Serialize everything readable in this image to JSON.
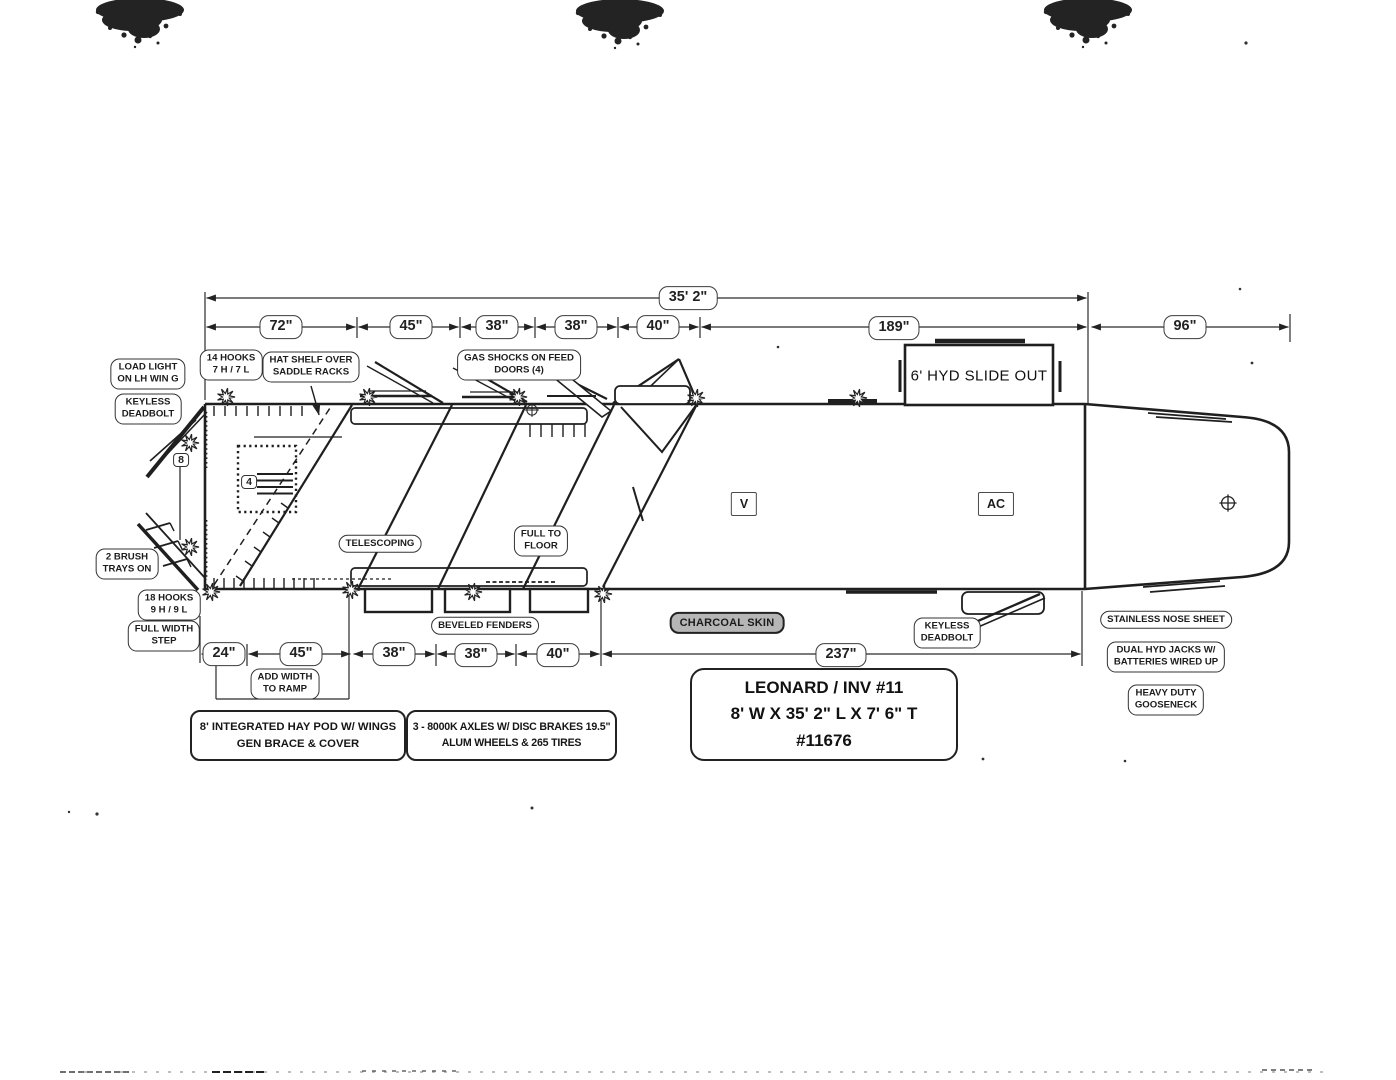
{
  "dims": {
    "overall": "35' 2\"",
    "top": [
      "72\"",
      "45\"",
      "38\"",
      "38\"",
      "40\"",
      "189\"",
      "96\""
    ],
    "bottom": [
      "24\"",
      "45\"",
      "38\"",
      "38\"",
      "40\"",
      "237\""
    ]
  },
  "notes": {
    "load_light": "LOAD LIGHT\nON LH WIN G",
    "keyless_rear": "KEYLESS\nDEADBOLT",
    "hooks_14": "14 HOOKS\n7 H / 7 L",
    "hat_shelf": "HAT SHELF OVER\nSADDLE RACKS",
    "gas_shocks": "GAS SHOCKS ON FEED\nDOORS (4)",
    "brush_trays": "2 BRUSH\nTRAYS ON",
    "hooks_18": "18 HOOKS\n9 H / 9 L",
    "full_width_step": "FULL WIDTH\nSTEP",
    "telescoping": "TELESCOPING",
    "full_to_floor": "FULL TO\nFLOOR",
    "add_width": "ADD WIDTH\nTO RAMP",
    "beveled_fenders": "BEVELED FENDERS",
    "charcoal_skin": "CHARCOAL SKIN",
    "keyless_front": "KEYLESS\nDEADBOLT",
    "stainless_nose": "STAINLESS NOSE SHEET",
    "dual_hyd": "DUAL HYD JACKS W/\nBATTERIES WIRED UP",
    "heavy_duty": "HEAVY DUTY\nGOOSENECK",
    "slide_out": "6' HYD SLIDE OUT",
    "vent": "V",
    "ac": "AC",
    "num_8": "8",
    "num_4": "4"
  },
  "title_block": {
    "line1": "LEONARD / INV #11",
    "line2": "8' W X 35' 2\" L X 7' 6\" T",
    "line3": "#11676"
  },
  "callouts": {
    "hay_pod": "8' INTEGRATED HAY POD W/ WINGS\nGEN BRACE & COVER",
    "axles": "3 - 8000K AXLES W/ DISC BRAKES 19.5\"\nALUM WHEELS & 265 TIRES"
  },
  "colors": {
    "ink": "#1f1f1f",
    "charcoal_chip": "#b6b6b6",
    "paper": "#ffffff"
  }
}
